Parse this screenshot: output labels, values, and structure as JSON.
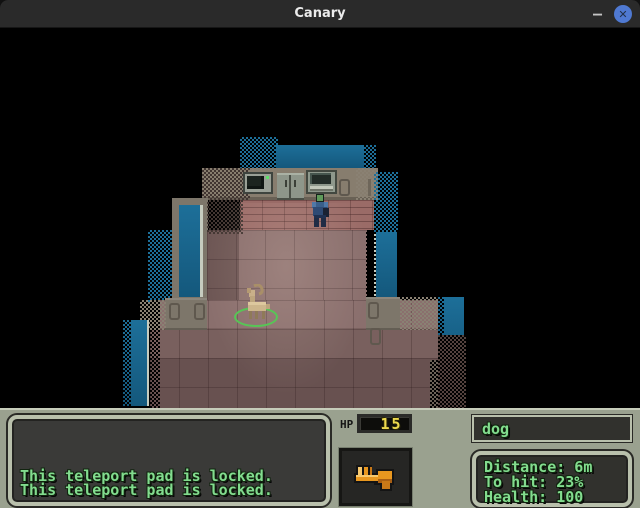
{
  "window": {
    "title": "Canary",
    "minimize_label": "–",
    "close_glyph": "✕"
  },
  "hud": {
    "log_lines": [
      "This teleport pad is locked.",
      "This teleport pad is locked."
    ],
    "hp_label": "HP",
    "hp_value": "15",
    "weapon_icon": "pistol-icon",
    "target_name": "dog",
    "target_stats": [
      "Distance: 6m",
      "To hit: 23%",
      "Health: 100"
    ]
  },
  "colors": {
    "titlebar": "#2a2a2a",
    "close_button": "#4f79d2",
    "teal_accent": "#1d6f99",
    "wall": "#7d766a",
    "floor": "#8a6f6d",
    "hud_background": "#9aa18f",
    "panel_frame": "#b9c0ac",
    "panel_interior": "#3a3a38",
    "text_green": "#82dc8e",
    "hp_yellow": "#ecd94e",
    "target_ring_green": "#57c556"
  }
}
